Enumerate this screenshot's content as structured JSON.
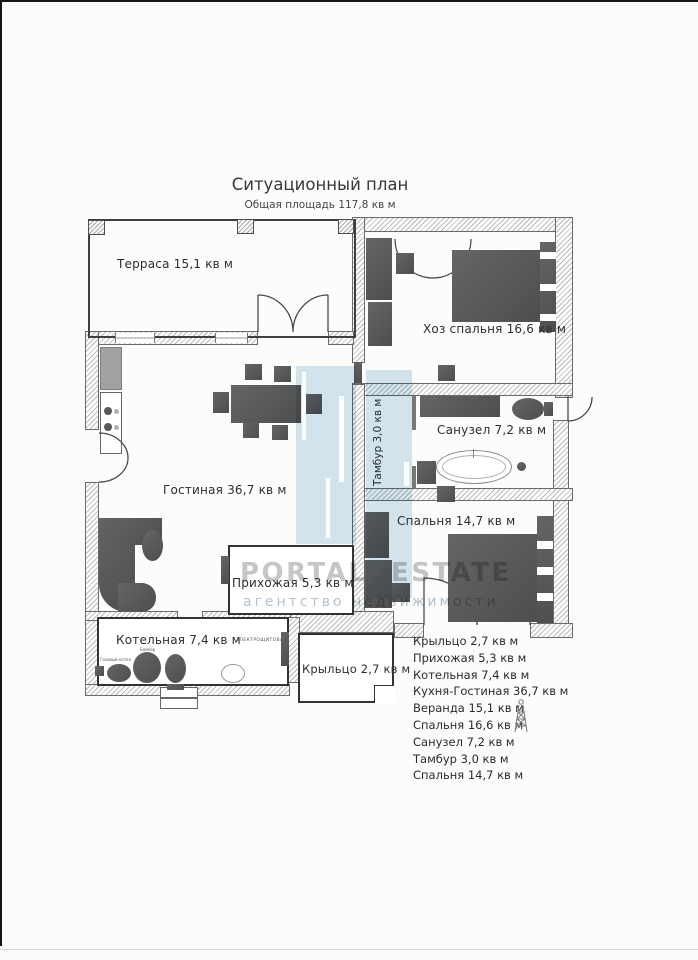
{
  "title": "Ситуационный план",
  "subtitle": "Общая площадь 117,8 кв м",
  "rooms": {
    "terrace": "Терраса 15,1 кв м",
    "master": "Хоз спальня 16,6 кв м",
    "tambour": "Тамбур 3,0 кв м",
    "bath": "Санузел 7,2 кв м",
    "bedroom": "Спальня 14,7 кв м",
    "living": "Гостиная 36,7 кв м",
    "hallway": "Прихожая 5,3 кв м",
    "boiler": "Котельная 7,4 кв м",
    "porch": "Крыльцо 2,7 кв м"
  },
  "boiler_labels": {
    "gas_boiler": "Газовый котел",
    "water_heater": "Бойлер",
    "panel": "ЭЛЕКТРОЩИТОВАЯ"
  },
  "legend": {
    "items": [
      "Крыльцо 2,7 кв м",
      "Прихожая 5,3 кв м",
      "Котельная 7,4 кв м",
      "Кухня-Гостиная 36,7 кв м",
      "Веранда 15,1 кв м",
      "Спальня 16,6 кв м",
      "Санузел 7,2 кв м",
      "Тамбур 3,0 кв м",
      "Спальня 14,7 кв м"
    ]
  },
  "watermark": {
    "brand": "PORTAL ESTATE",
    "tagline": "агентство недвижимости"
  },
  "colors": {
    "watermark_blue": "#d5e6f0",
    "furniture_gray": "#585858",
    "wall_hatch_gray": "#bcbcbc"
  }
}
